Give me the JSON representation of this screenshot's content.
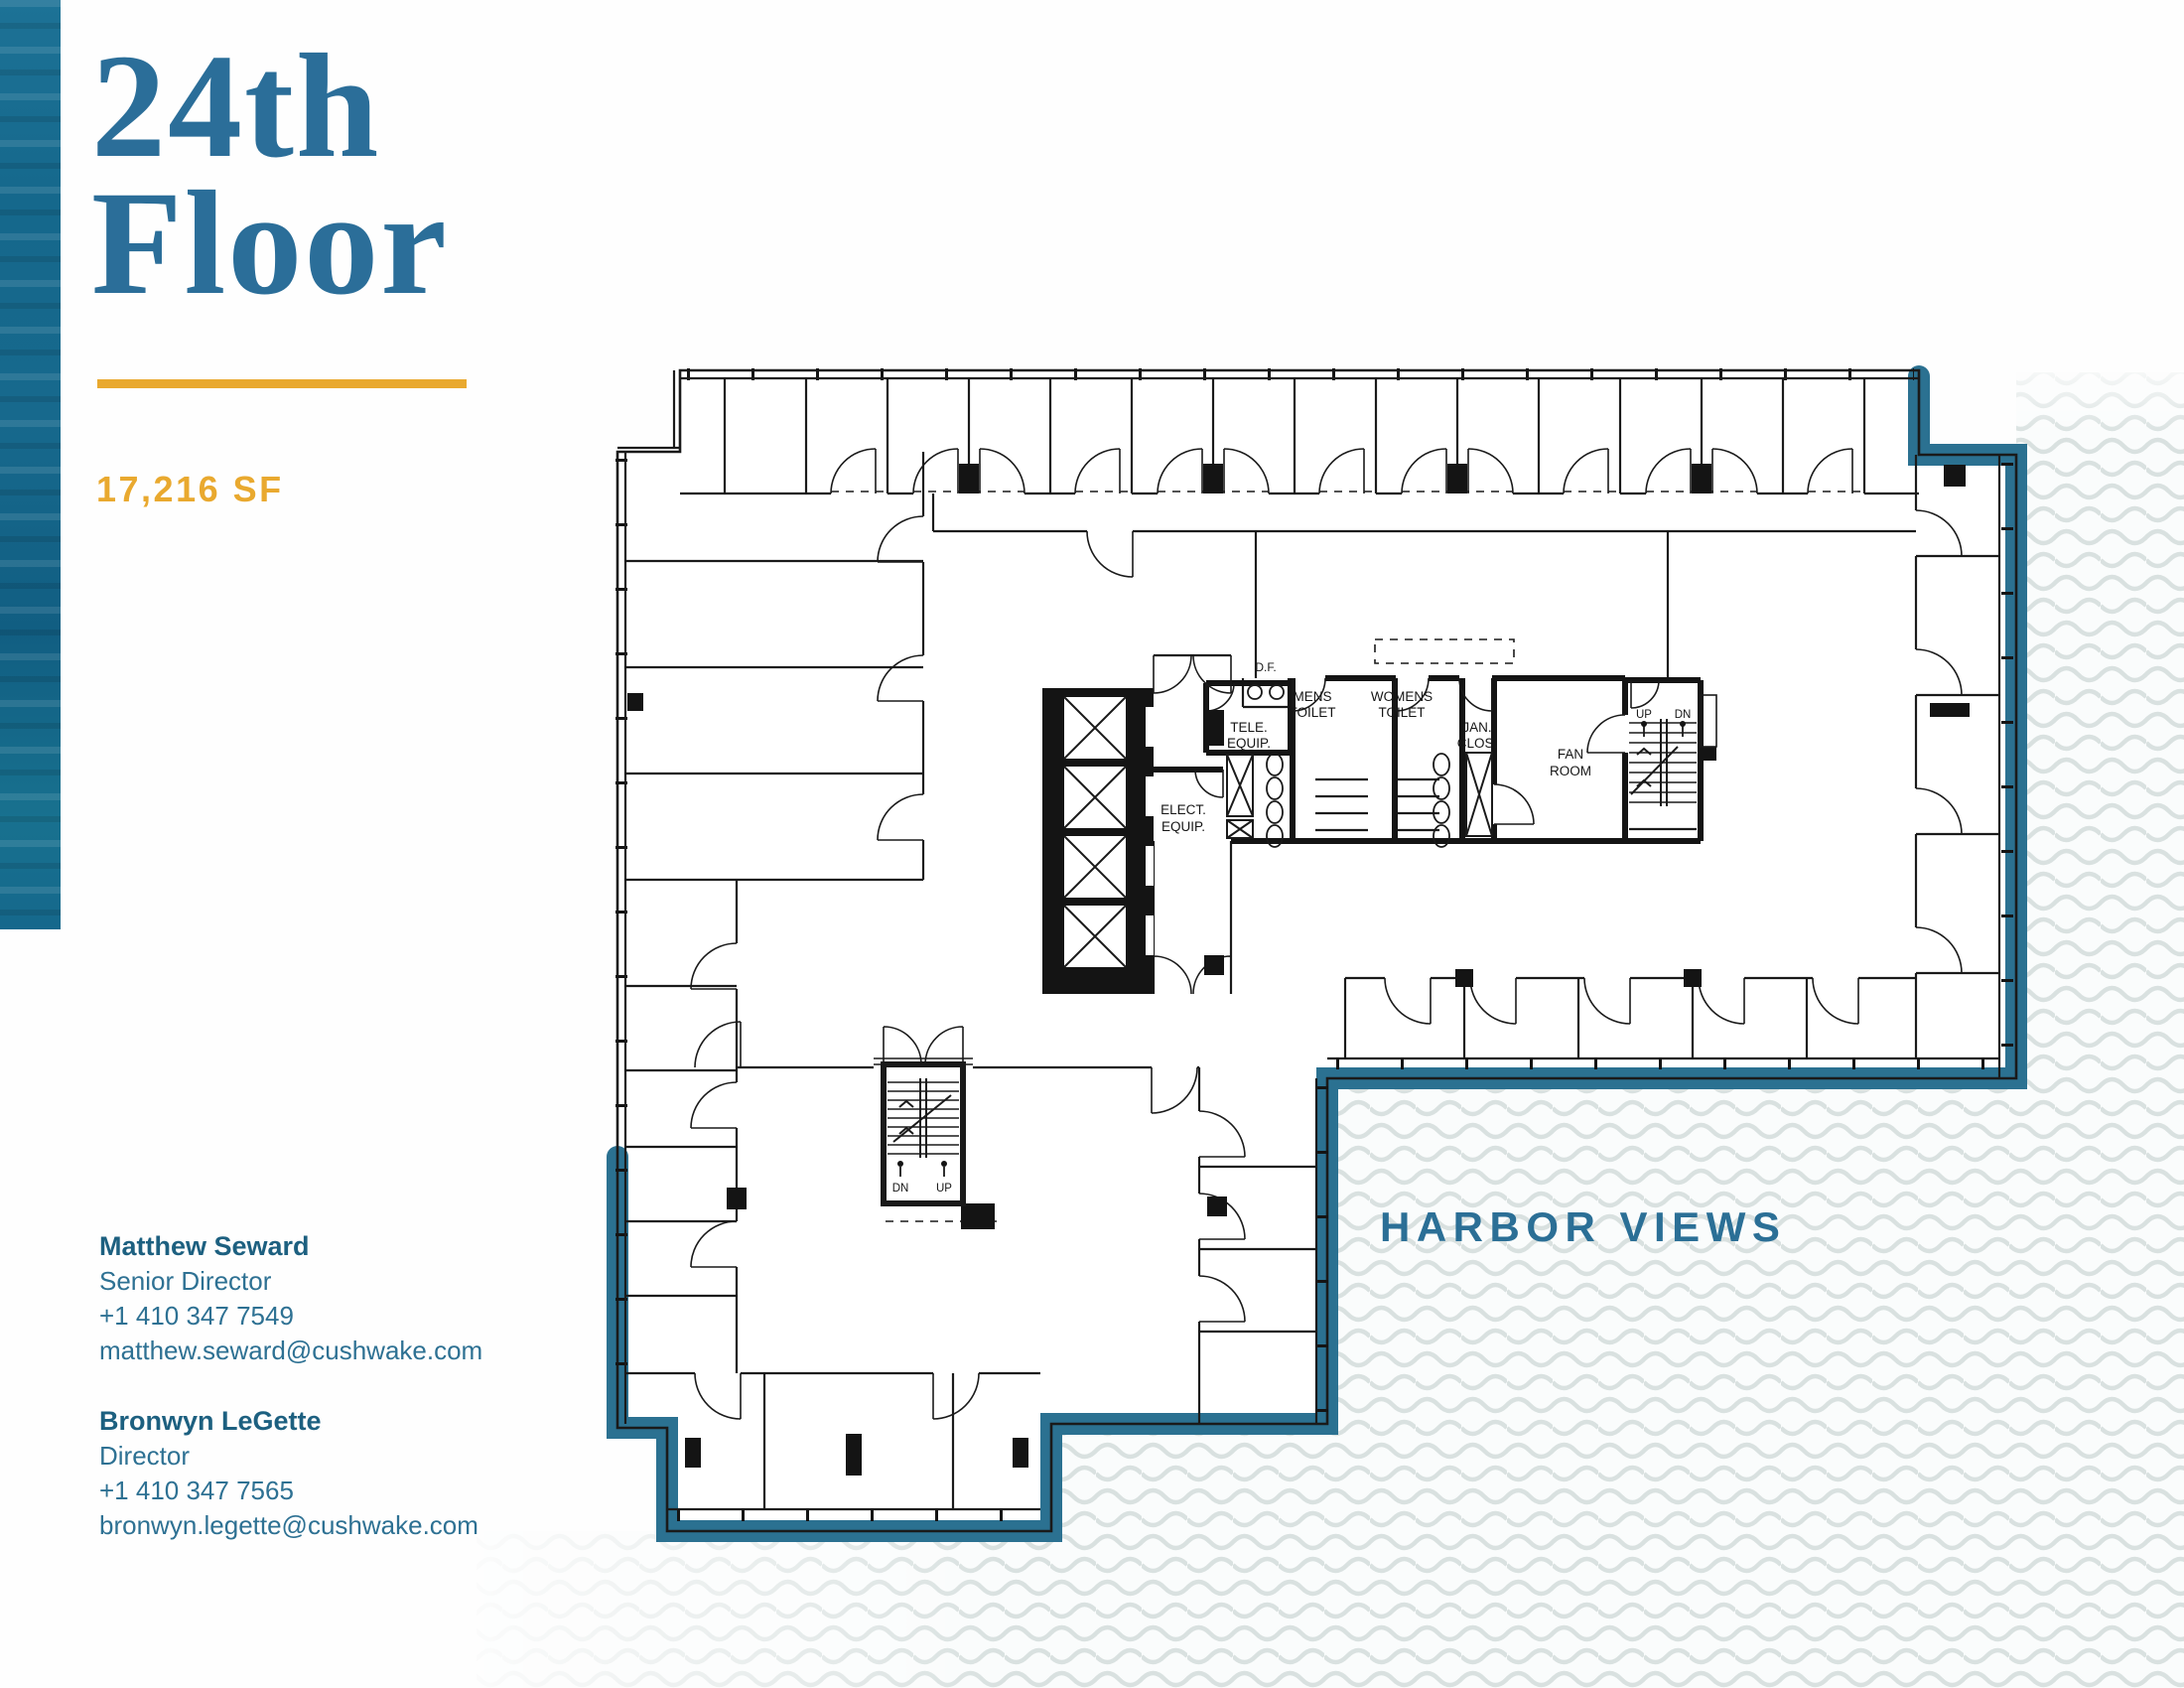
{
  "palette": {
    "primary_blue": "#2b6e99",
    "teal_border": "#2b7191",
    "sidebar_blue": "#15688c",
    "gold": "#e9a92f",
    "plan_ink": "#161616",
    "wave_gray": "#d9e1e0",
    "contact_name": "#1d6080",
    "contact_text": "#2e7193"
  },
  "header": {
    "title_line1": "24th",
    "title_line2": "Floor",
    "area": "17,216 SF"
  },
  "contacts": [
    {
      "name": "Matthew Seward",
      "title": "Senior Director",
      "phone": "+1 410 347 7549",
      "email": "matthew.seward@cushwake.com"
    },
    {
      "name": "Bronwyn LeGette",
      "title": "Director",
      "phone": "+1 410 347 7565",
      "email": "bronwyn.legette@cushwake.com"
    }
  ],
  "plan": {
    "df": "D.F.",
    "mens1": "MENS",
    "mens2": "TOILET",
    "womens1": "WOMENS",
    "womens2": "TOILET",
    "tele1": "TELE.",
    "tele2": "EQUIP.",
    "elect1": "ELECT.",
    "elect2": "EQUIP.",
    "jan1": "JAN.",
    "jan2": "CLOS.",
    "fan1": "FAN",
    "fan2": "ROOM",
    "stair_up": "UP",
    "stair_dn": "DN",
    "leg_stair_dn": "DN",
    "leg_stair_up": "UP"
  },
  "harbor": {
    "label": "HARBOR VIEWS"
  }
}
